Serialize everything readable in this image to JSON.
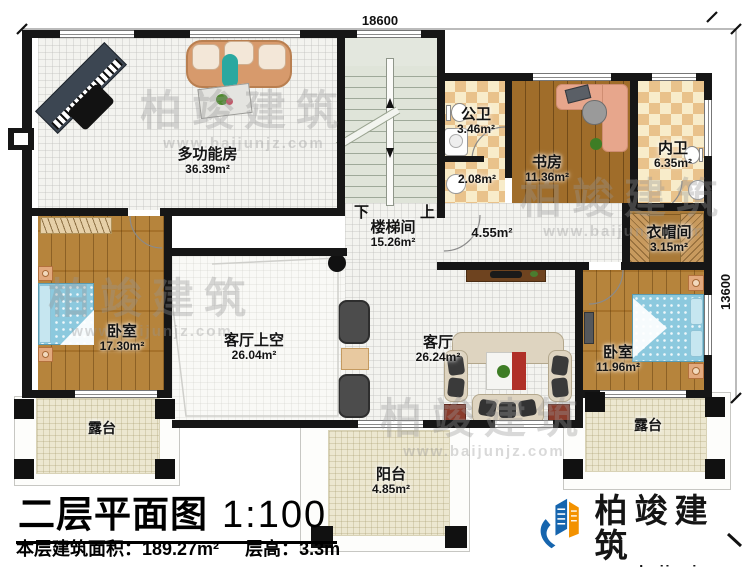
{
  "document": {
    "title": "二层平面图",
    "scale": "1:100",
    "stats": {
      "area_label": "本层建筑面积：",
      "area_value": "189.27m²",
      "height_label": "层高：",
      "height_value": "3.3m"
    }
  },
  "dimensions": {
    "width_mm": "18600",
    "depth_mm": "13600"
  },
  "stairs": {
    "down_label": "下",
    "up_label": "上"
  },
  "rooms": {
    "multifunction": {
      "label": "多功能房",
      "area": "36.39m²"
    },
    "stairwell": {
      "label": "楼梯间",
      "area": "15.26m²"
    },
    "hallway": {
      "area": "4.55m²"
    },
    "public_bath": {
      "label": "公卫",
      "area": "3.46m²"
    },
    "wash_area": {
      "area": "2.08m²"
    },
    "study": {
      "label": "书房",
      "area": "11.36m²"
    },
    "private_bath": {
      "label": "内卫",
      "area": "6.35m²"
    },
    "cloakroom": {
      "label": "衣帽间",
      "area": "3.15m²"
    },
    "bedroom_left": {
      "label": "卧室",
      "area": "17.30m²"
    },
    "living_void": {
      "label": "客厅上空",
      "area": "26.04m²"
    },
    "living": {
      "label": "客厅",
      "area": "26.24m²"
    },
    "bedroom_right": {
      "label": "卧室",
      "area": "11.96m²"
    },
    "terrace_left": {
      "label": "露台"
    },
    "terrace_right": {
      "label": "露台"
    },
    "balcony": {
      "label": "阳台",
      "area": "4.85m²"
    }
  },
  "branding": {
    "company": "柏竣建筑",
    "website": "www.baijunjz.com"
  },
  "watermark": {
    "text": "柏竣建筑",
    "sub": "www.baijunjz.com"
  },
  "colors": {
    "wall": "#161616",
    "wood_floor": "#b27d31",
    "tile_dark": "#e9c28b",
    "tile_light": "#f8ecca",
    "bed_blue": "#8cc9de",
    "logo_blue": "#1665ae",
    "logo_orange": "#f39200"
  }
}
